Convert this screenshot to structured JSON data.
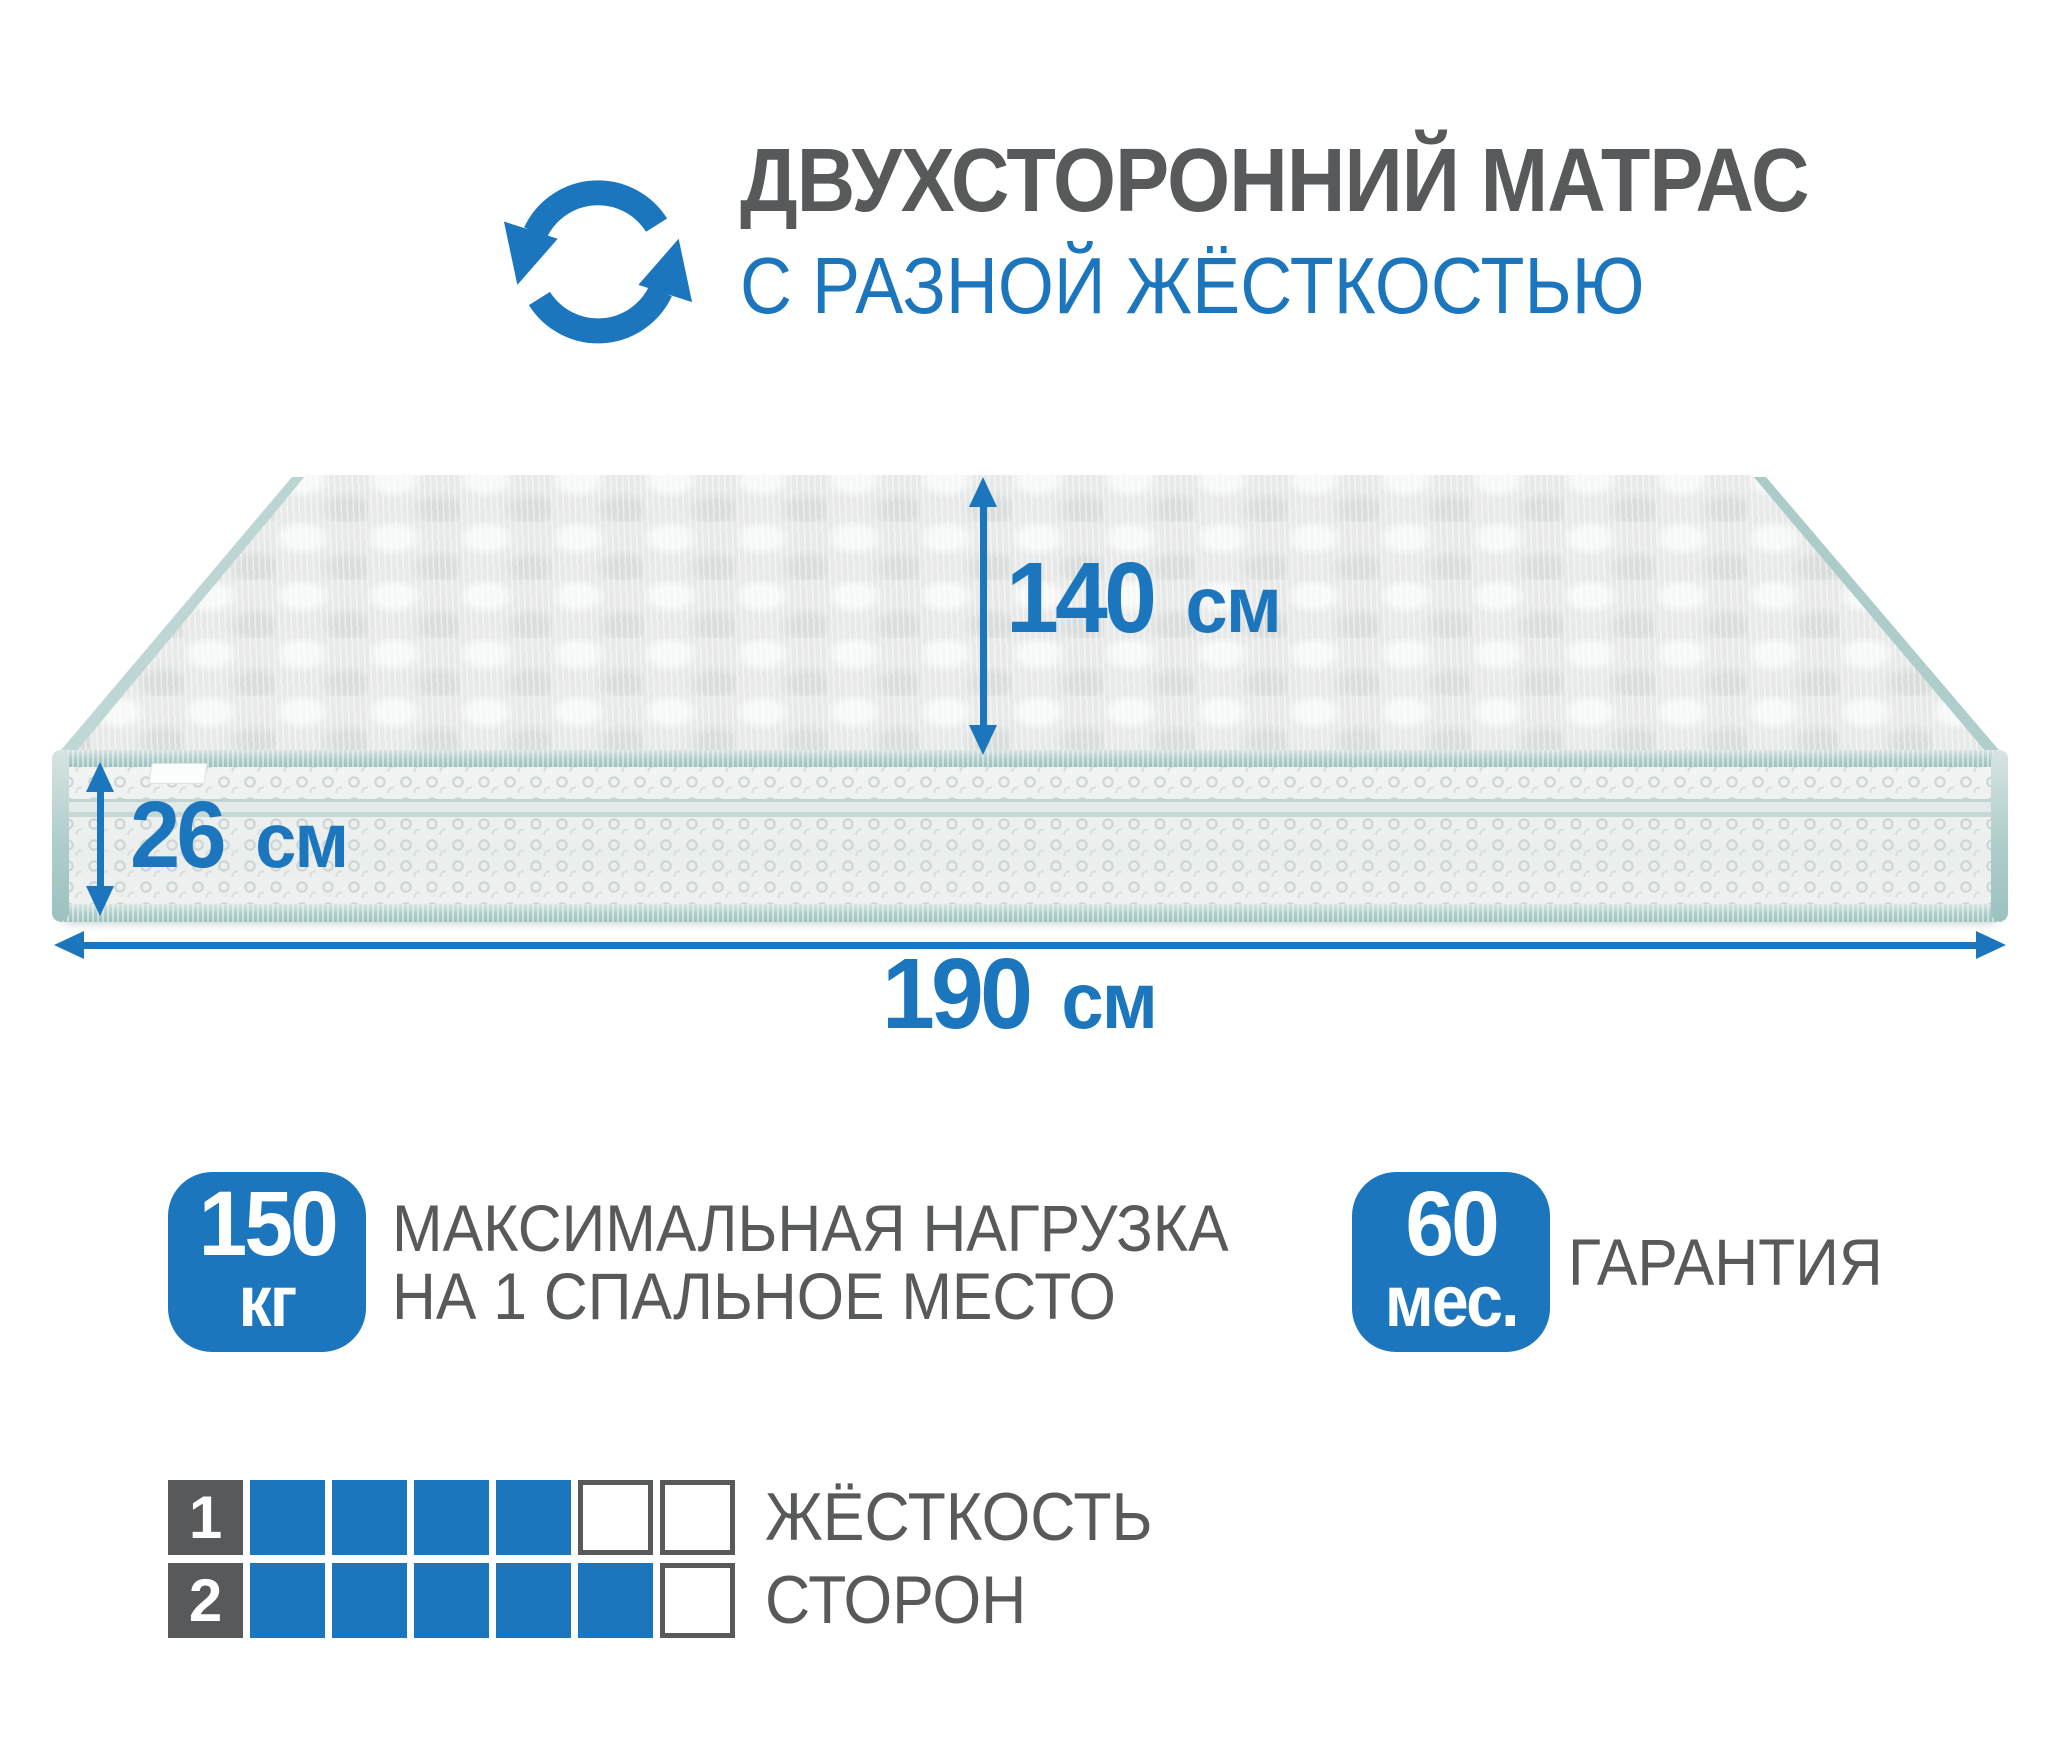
{
  "header": {
    "title_line1": "ДВУХСТОРОННИЙ МАТРАС",
    "title_line2": "С РАЗНОЙ ЖЁСТКОСТЬЮ",
    "icon": "rotate-arrows-icon"
  },
  "dimensions": {
    "width": {
      "value": "140",
      "unit": "см"
    },
    "height": {
      "value": "26",
      "unit": "см"
    },
    "length": {
      "value": "190",
      "unit": "см"
    }
  },
  "load_badge": {
    "value": "150",
    "unit": "кг",
    "label_line1": "МАКСИМАЛЬНАЯ НАГРУЗКА",
    "label_line2": "НА 1 СПАЛЬНОЕ МЕСТО"
  },
  "warranty_badge": {
    "value": "60",
    "unit": "мес.",
    "label": "ГАРАНТИЯ"
  },
  "firmness": {
    "title_line1": "ЖЁСТКОСТЬ",
    "title_line2": "СТОРОН",
    "rows": [
      {
        "side": "1",
        "filled": 4,
        "total": 6
      },
      {
        "side": "2",
        "filled": 5,
        "total": 6
      }
    ]
  },
  "colors": {
    "accent_blue": "#1c76bd",
    "text_gray": "#58595b",
    "square_gray": "#58595b",
    "piping_teal": "#a5c9c6",
    "mattress_top": "#e8eae9",
    "mattress_side": "#eff1f0"
  }
}
